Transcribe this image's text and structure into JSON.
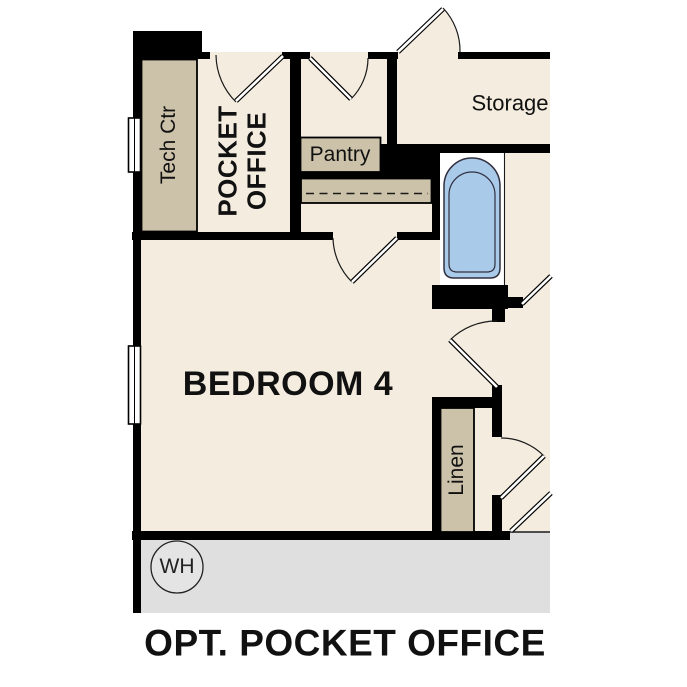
{
  "plan": {
    "caption": "OPT. POCKET OFFICE",
    "labels": {
      "tech_ctr": "Tech Ctr",
      "pocket_office": "POCKET\nOFFICE",
      "pantry": "Pantry",
      "storage": "Storage",
      "bedroom": "BEDROOM 4",
      "linen": "Linen",
      "water_heater": "WH"
    },
    "fixtures": [
      "bathtub",
      "water-heater",
      "window",
      "door-swing"
    ],
    "colors": {
      "wall": "#000000",
      "floor": "#f4eddf",
      "cabinet": "#ccc2a9",
      "garage": "#dfdfdf",
      "tub": "#aacae9",
      "line": "#1a1a1a",
      "bg": "#ffffff",
      "text": "#111111"
    }
  }
}
